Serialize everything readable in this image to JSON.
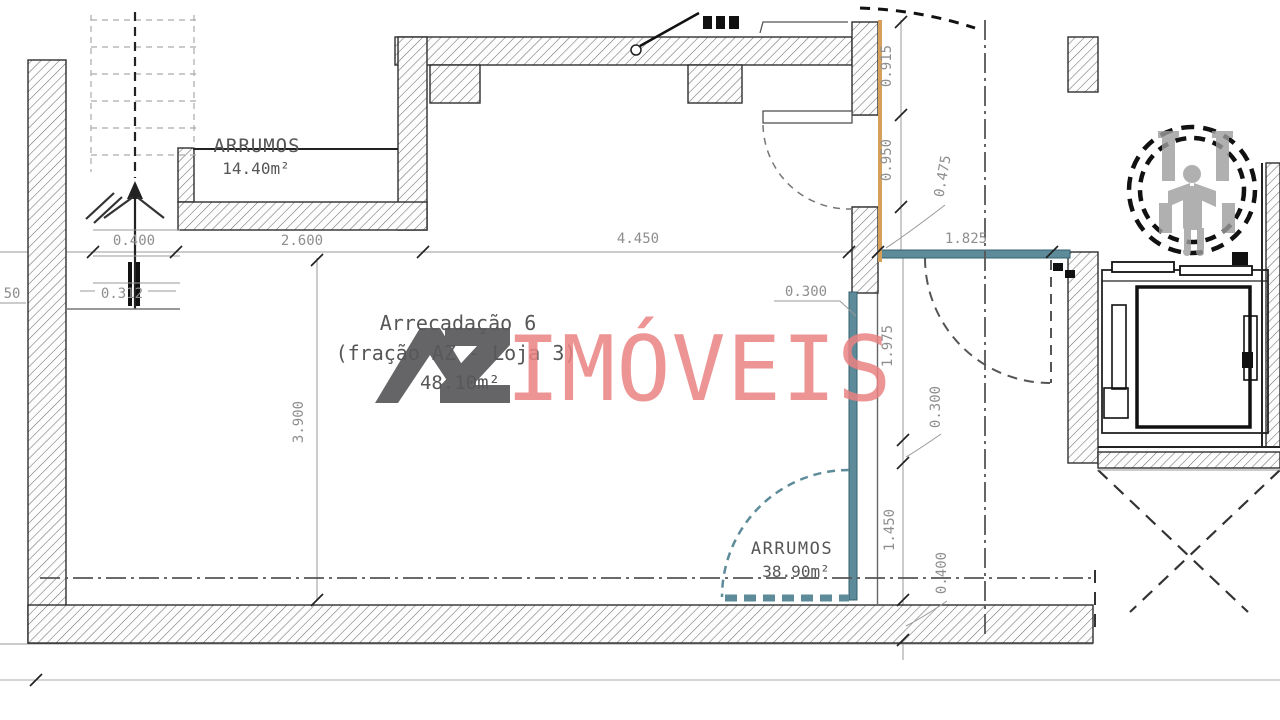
{
  "plan": {
    "rooms": {
      "arrumos_top": {
        "name": "ARRUMOS",
        "area": "14.40m²"
      },
      "arrecadacao": {
        "name": "Arrecadação 6",
        "fraction": "(fração AZ - Loja 3)",
        "area": "48.10m²"
      },
      "arrumos_bottom": {
        "name": "ARRUMOS",
        "area": "38.90m²"
      }
    },
    "dims": {
      "v0400": "0.400",
      "v2600": "2.600",
      "v4450": "4.450",
      "v1825": "1.825",
      "v0312": "0.312",
      "vleft50": "50",
      "v3900": "3.900",
      "v0915": "0.915",
      "v0950": "0.950",
      "v0475": "0.475",
      "v0300a": "0.300",
      "v1975": "1.975",
      "v0300b": "0.300",
      "v1450": "1.450",
      "v0400b": "0.400"
    },
    "watermark": {
      "logo": "AZ",
      "name": "IMÓVEIS"
    },
    "colors": {
      "teal": "#5e8b99",
      "teal_dark": "#33606e",
      "orange": "#d4a05c",
      "watermark_red": "#ea8282",
      "watermark_gray": "#58595b"
    }
  }
}
